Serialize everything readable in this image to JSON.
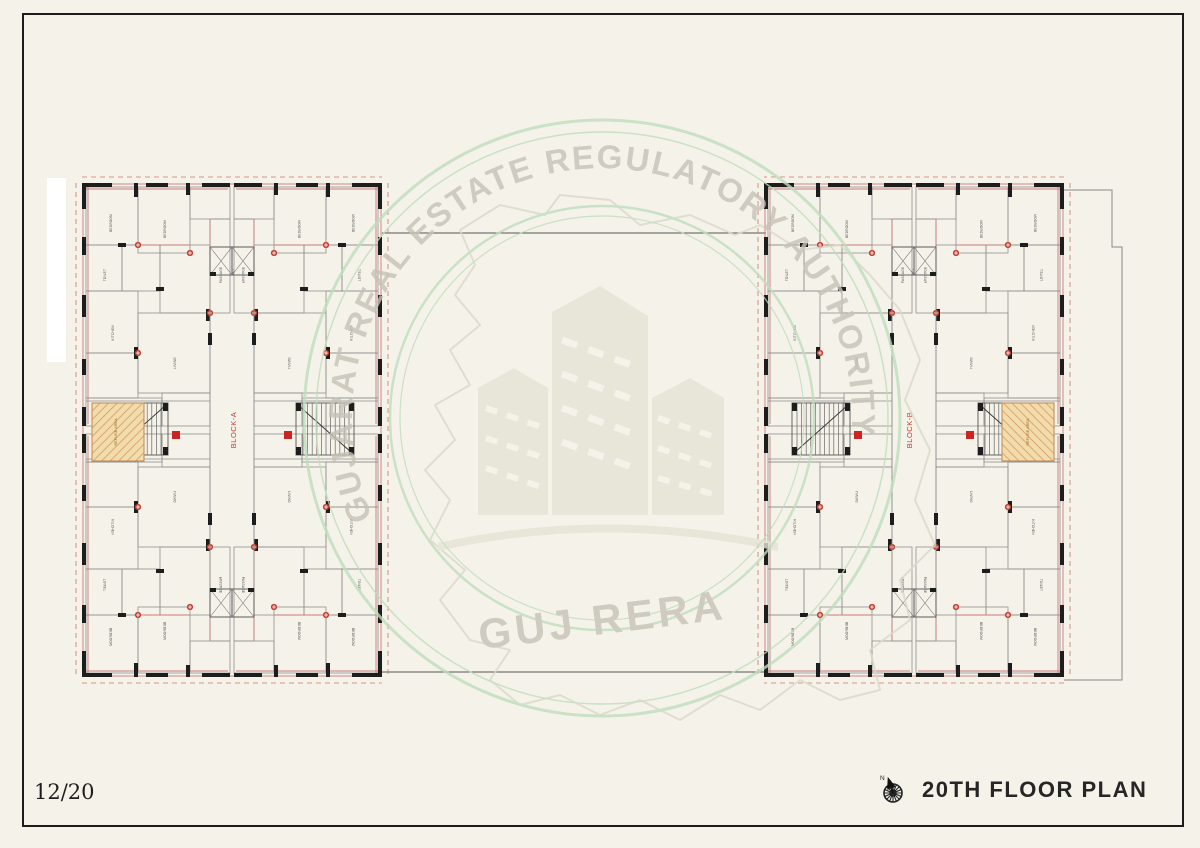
{
  "sheet": {
    "page_number": "12/20",
    "title": "20TH FLOOR PLAN",
    "compass_label": "N"
  },
  "watermark": {
    "arc_text": "GUJARAT REAL ESTATE REGULATORY AUTHORITY",
    "wordmark": "GUJ RERA"
  },
  "plan": {
    "blocks": [
      {
        "label": "BLOCK-A"
      },
      {
        "label": "BLOCK-B"
      }
    ],
    "refuge_label": "REFUGE AREA",
    "room_labels": {
      "bedroom": "BEDROOM",
      "toilet": "TOILET",
      "kitchen": "KITCHEN",
      "living": "LIVING",
      "passage": "PASSAGE",
      "lift": "LIFT",
      "stair_up": "UP"
    }
  },
  "colors": {
    "paper": "#f5f2e9",
    "frame": "#1c1c1c",
    "wall_black": "#1d1d1d",
    "partition_gray": "#8f8f8f",
    "accent_red": "#c0392b",
    "dim_pink": "#cc8888",
    "refuge_fill": "#f3dcab",
    "watermark_green": "#bfddbc",
    "watermark_gray": "#c6c2b6"
  }
}
